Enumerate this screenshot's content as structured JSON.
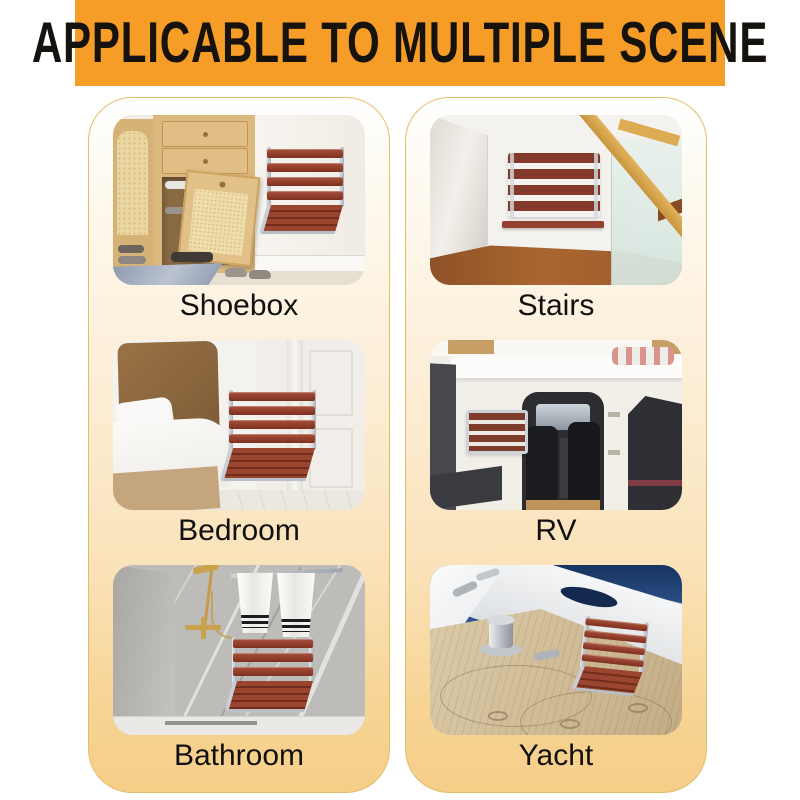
{
  "banner": {
    "title": "APPLICABLE TO MULTIPLE SCENE",
    "background_color": "#F59D26",
    "text_color": "#16120E"
  },
  "scenes": [
    {
      "label": "Shoebox",
      "photo_icon": "shoebox-photo",
      "seat_state": "unfolded"
    },
    {
      "label": "Stairs",
      "photo_icon": "stairs-photo",
      "seat_state": "folded"
    },
    {
      "label": "Bedroom",
      "photo_icon": "bedroom-photo",
      "seat_state": "unfolded"
    },
    {
      "label": "RV",
      "photo_icon": "rv-photo",
      "seat_state": "folded"
    },
    {
      "label": "Bathroom",
      "photo_icon": "bathroom-photo",
      "seat_state": "unfolded"
    },
    {
      "label": "Yacht",
      "photo_icon": "yacht-photo",
      "seat_state": "unfolded"
    }
  ],
  "colors": {
    "card_border": "#E3BC6A",
    "card_gradient_top": "#FFFFFF",
    "card_gradient_bottom": "#F5CE88",
    "label_text": "#101010",
    "seat_wood": "#8B3A28",
    "seat_frame": "#C9CED4"
  }
}
